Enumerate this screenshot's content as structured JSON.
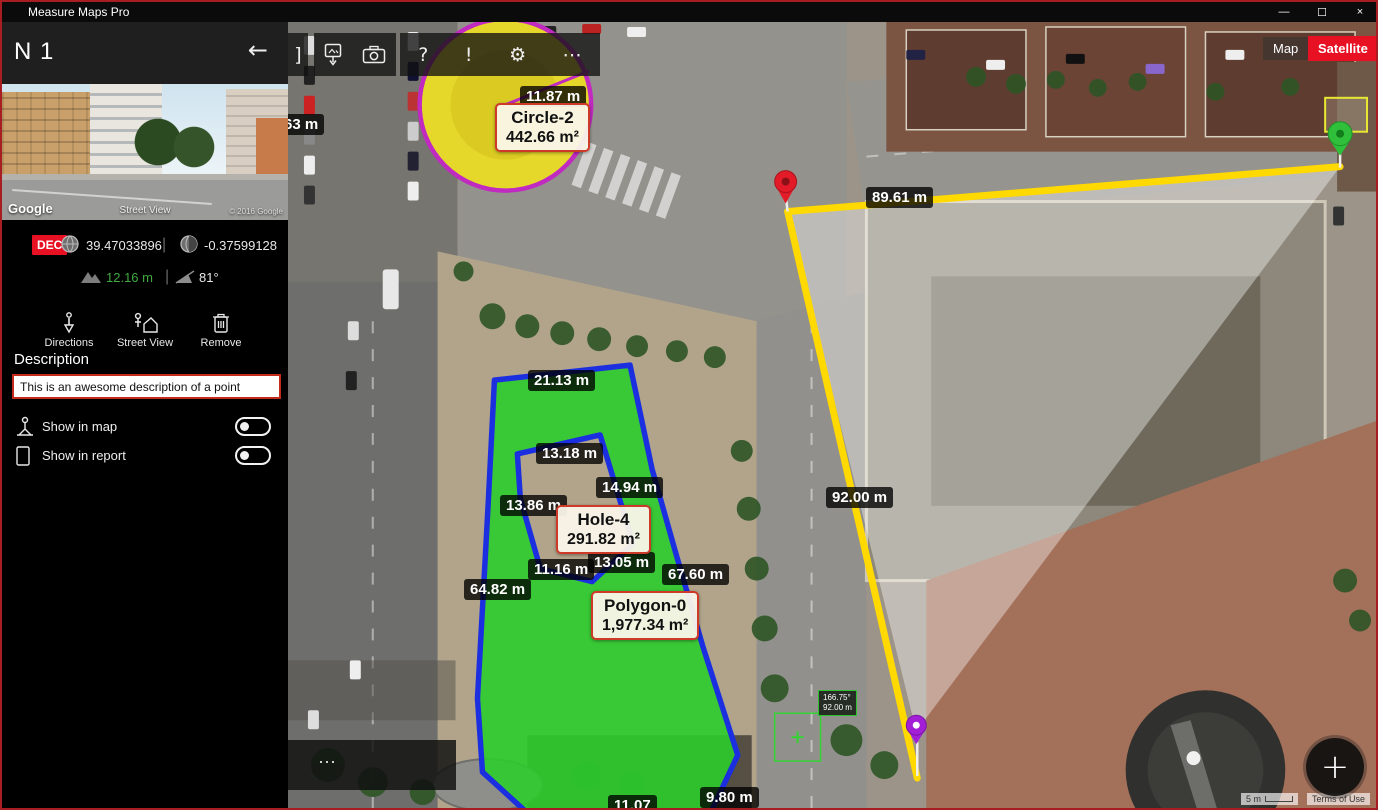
{
  "window": {
    "title": "Measure Maps Pro",
    "minimize": "—",
    "maximize": "☐",
    "close": "×"
  },
  "sidebar": {
    "point_name": "N 1",
    "back_glyph": "←",
    "street_view": {
      "google": "Google",
      "label": "Street View",
      "copyright": "© 2016 Google"
    },
    "coord_format": "DEC",
    "latitude": "39.47033896",
    "longitude": "-0.37599128",
    "divider": "|",
    "elevation": "12.16 m",
    "bearing": "81°",
    "actions": [
      {
        "label": "Directions"
      },
      {
        "label": "Street View"
      },
      {
        "label": "Remove"
      }
    ],
    "description_heading": "Description",
    "description_value": "This is an awesome description of a point",
    "toggles": [
      {
        "label": "Show in map",
        "state": "off"
      },
      {
        "label": "Show in report",
        "state": "off"
      }
    ]
  },
  "toolbar": {
    "partial_glyph": "]",
    "help_glyph": "?",
    "alert_glyph": "!",
    "settings_glyph": "⚙",
    "more_glyph": "⋯"
  },
  "map": {
    "view_buttons": [
      {
        "label": "Map",
        "active": false
      },
      {
        "label": "Satellite",
        "active": true
      }
    ],
    "distance_labels": [
      {
        "text": "11.87 m"
      },
      {
        "text": "63 m"
      },
      {
        "text": "21.13 m"
      },
      {
        "text": "13.18 m"
      },
      {
        "text": "14.94 m"
      },
      {
        "text": "13.86 m"
      },
      {
        "text": "11.16 m"
      },
      {
        "text": "13.05 m"
      },
      {
        "text": "67.60 m"
      },
      {
        "text": "64.82 m"
      },
      {
        "text": "9.80 m"
      },
      {
        "text": "11.07"
      },
      {
        "text": "89.61 m"
      },
      {
        "text": "92.00 m"
      }
    ],
    "measure_boxes": [
      {
        "name": "Circle-2",
        "area": "442.66 m²"
      },
      {
        "name": "Hole-4",
        "area": "291.82 m²"
      },
      {
        "name": "Polygon-0",
        "area": "1,977.34 m²"
      }
    ],
    "cursor_tooltip": {
      "angle": "166.75°",
      "distance": "92.00 m"
    },
    "footer": {
      "scale": "5 m",
      "terms": "Terms of Use",
      "more": "⋯"
    },
    "fab": "+"
  }
}
